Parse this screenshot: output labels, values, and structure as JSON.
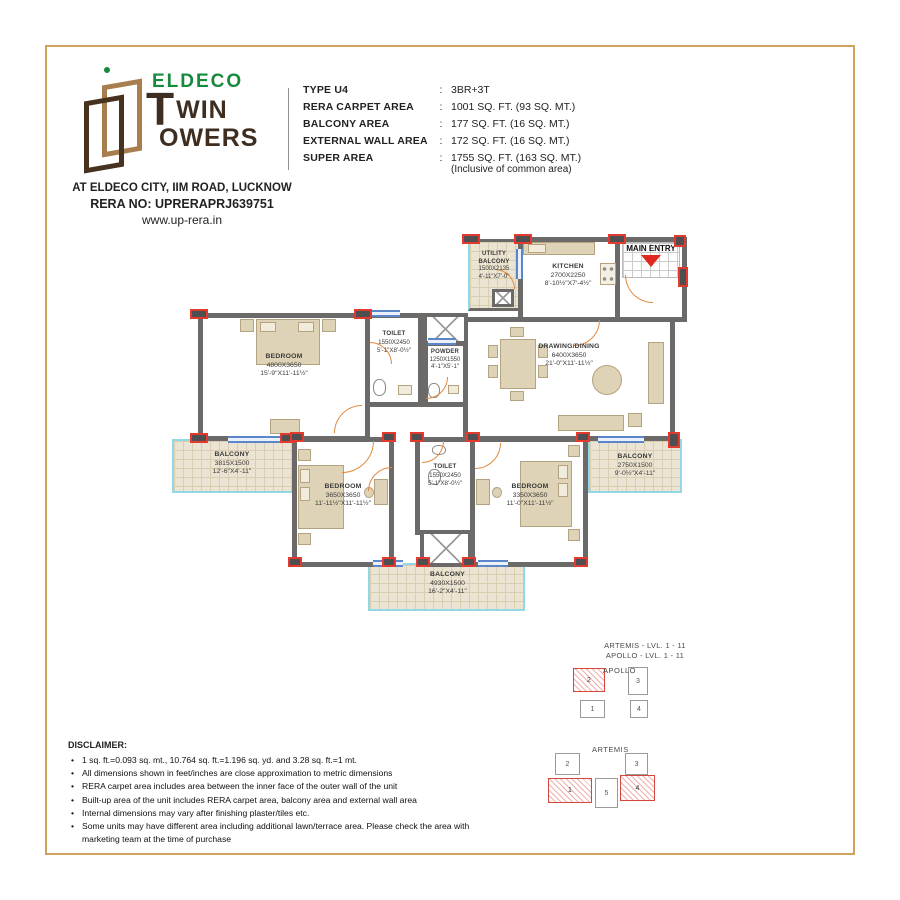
{
  "header": {
    "logo": {
      "eldeco": "ELDECO",
      "wordmark_t": "T",
      "wordmark_win": "WIN",
      "wordmark_owers": "OWERS",
      "address": "AT ELDECO CITY, IIM ROAD, LUCKNOW",
      "rera_no": "RERA NO: UPRERAPRJ639751",
      "website": "www.up-rera.in"
    },
    "colon": ":",
    "specs": [
      {
        "label": "TYPE U4",
        "value": "3BR+3T"
      },
      {
        "label": "RERA CARPET AREA",
        "value": "1001 SQ. FT. (93 SQ. MT.)"
      },
      {
        "label": "BALCONY AREA",
        "value": "177 SQ. FT. (16 SQ. MT.)"
      },
      {
        "label": "EXTERNAL WALL AREA",
        "value": "172 SQ. FT. (16 SQ. MT.)"
      },
      {
        "label": "SUPER AREA",
        "value": "1755 SQ. FT. (163 SQ. MT.)",
        "note": "(Inclusive of common area)"
      }
    ]
  },
  "plan": {
    "main_entry_label": "MAIN ENTRY",
    "rooms": [
      {
        "name": "UTILITY BALCONY",
        "dim_mm": "1500X2135",
        "dim_ft": "4'-11\"X7'-0\""
      },
      {
        "name": "KITCHEN",
        "dim_mm": "2700X2250",
        "dim_ft": "8'-10½\"X7'-4½\""
      },
      {
        "name": "BEDROOM",
        "dim_mm": "4800X3650",
        "dim_ft": "15'-9\"X11'-11½\""
      },
      {
        "name": "TOILET",
        "dim_mm": "1550X2450",
        "dim_ft": "5'-1\"X8'-0½\""
      },
      {
        "name": "POWDER",
        "dim_mm": "1250X1550",
        "dim_ft": "4'-1\"X5'-1\""
      },
      {
        "name": "DRAWING/DINING",
        "dim_mm": "6400X3650",
        "dim_ft": "21'-0\"X11'-11½\""
      },
      {
        "name": "BALCONY",
        "dim_mm": "3815X1500",
        "dim_ft": "12'-6\"X4'-11\""
      },
      {
        "name": "BALCONY",
        "dim_mm": "2750X1500",
        "dim_ft": "9'-0½\"X4'-11\""
      },
      {
        "name": "BEDROOM",
        "dim_mm": "3650X3650",
        "dim_ft": "11'-11½\"X11'-11½\""
      },
      {
        "name": "TOILET",
        "dim_mm": "1550X2450",
        "dim_ft": "5'-1\"X8'-0½\""
      },
      {
        "name": "BEDROOM",
        "dim_mm": "3350X3650",
        "dim_ft": "11'-0\"X11'-11½\""
      },
      {
        "name": "BALCONY",
        "dim_mm": "4930X1500",
        "dim_ft": "16'-2\"X4'-11\""
      }
    ]
  },
  "keyplan": {
    "line1": "ARTEMIS - LVL. 1 - 11",
    "line2": "APOLLO - LVL. 1 - 11",
    "apollo": {
      "label": "APOLLO",
      "units": [
        "1",
        "2",
        "3",
        "4"
      ]
    },
    "artemis": {
      "label": "ARTEMIS",
      "units": [
        "1",
        "2",
        "3",
        "4",
        "5"
      ]
    }
  },
  "disclaimer": {
    "title": "DISCLAIMER:",
    "items": [
      "1 sq. ft.=0.093 sq. mt., 10.764 sq. ft.=1.196 sq. yd. and 3.28 sq. ft.=1 mt.",
      "All dimensions shown in feet/inches are close approximation to metric dimensions",
      "RERA carpet area includes area between the inner face of the outer wall of the unit",
      "Built-up area of the unit includes RERA carpet area, balcony area and external wall area",
      "Internal dimensions may vary after finishing plaster/tiles etc.",
      "Some units may have different area including additional lawn/terrace area. Please check the area with marketing team at the time of purchase"
    ]
  },
  "colors": {
    "accent_green": "#168a3e",
    "brand_brown": "#3f2d20",
    "gold_border": "#cfa35c",
    "wall_gray": "#6b6a68",
    "red_accent": "#e23b2e",
    "door_orange": "#e2893d",
    "balcony_edge": "#93d8e4",
    "entry_arrow_red": "#e0281e"
  }
}
